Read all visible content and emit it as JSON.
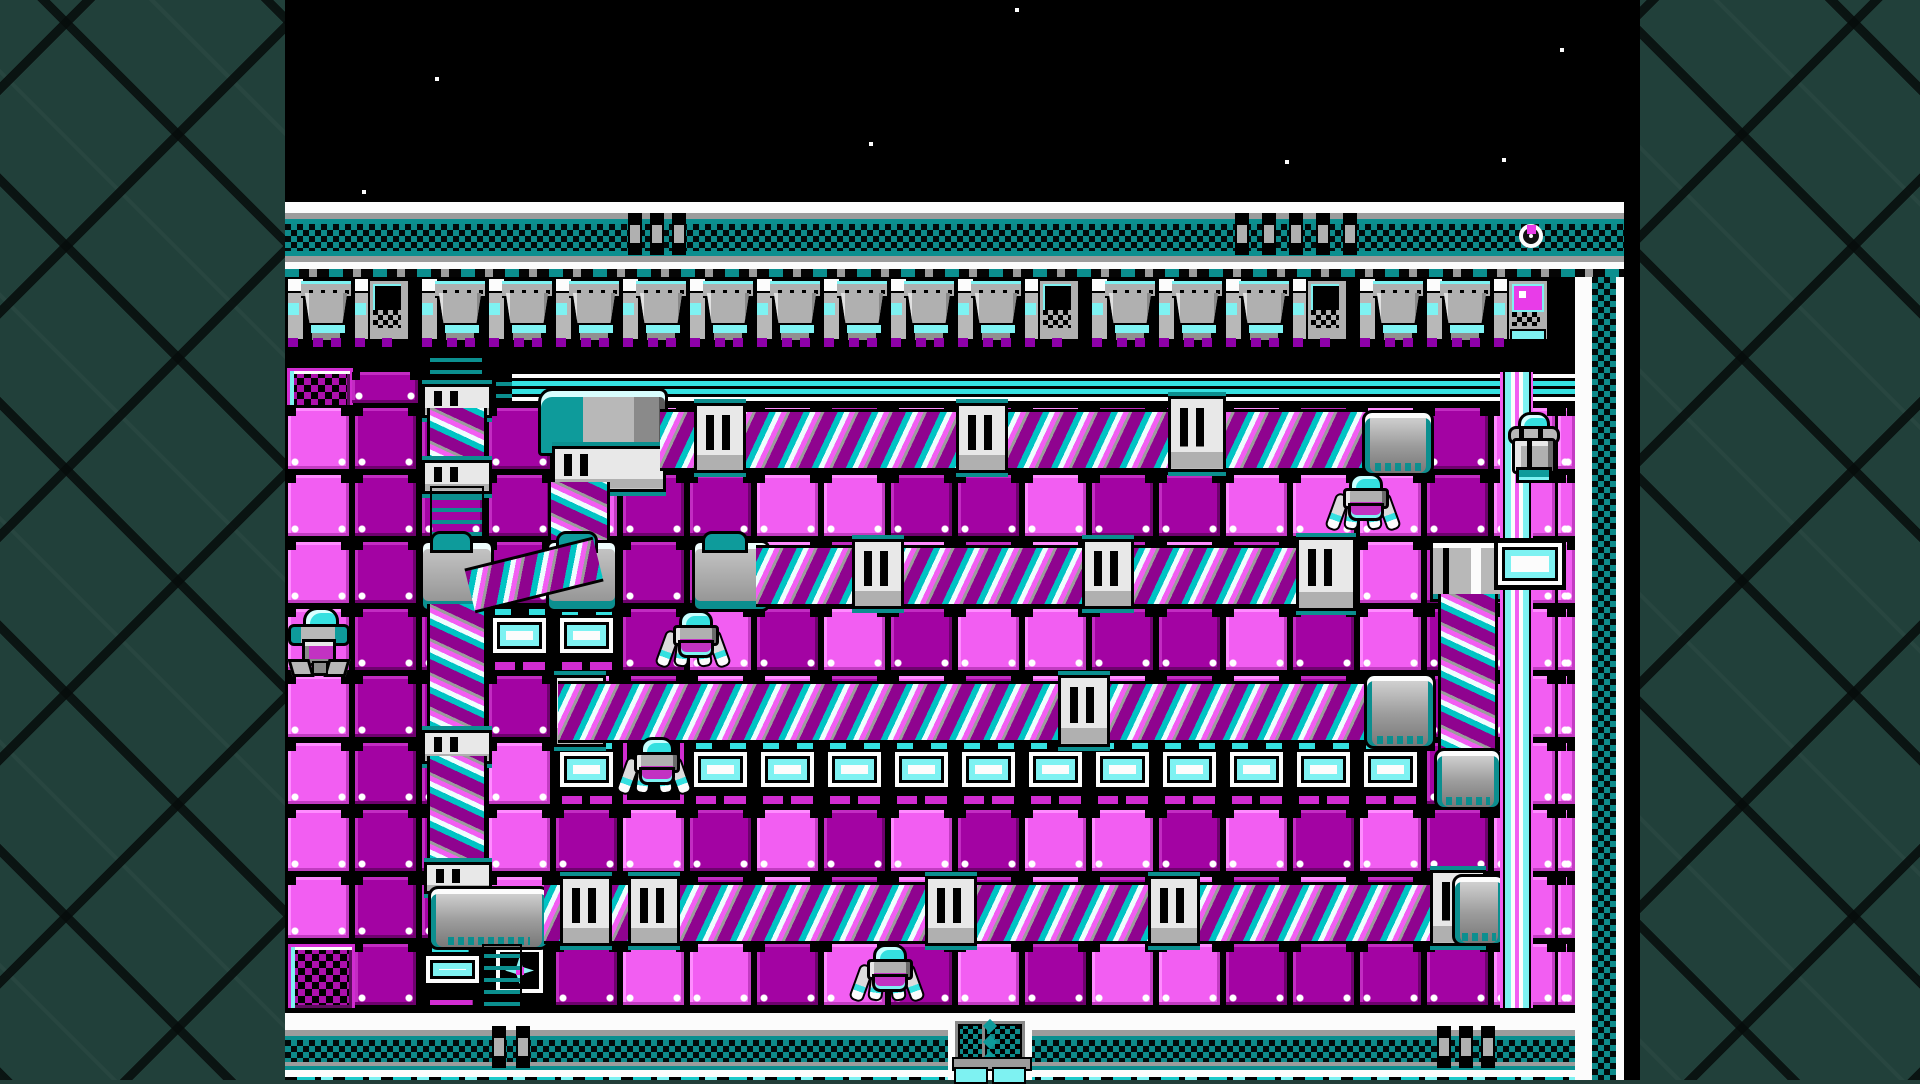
{
  "scene": "nes-action-stage-screenshot",
  "colors": {
    "background_lattice": "#21403a",
    "lattice_line": "#0a100f",
    "black": "#000000",
    "white": "#fcfcfc",
    "gray": "#9c9c9c",
    "light_gray": "#e8e8e8",
    "teal": "#0b8f8f",
    "teal_checker": "#0e8b8b",
    "cyan": "#35e0e0",
    "pale_cyan": "#7ef2f2",
    "magenta_bright": "#f25ef2",
    "magenta_mid": "#d12cd1",
    "purple_dark": "#a303a3",
    "shoe_purple": "#8e00a8"
  },
  "game_screen": {
    "x": 285,
    "y": 0,
    "width": 1355,
    "height": 1080
  },
  "starfield": {
    "height": 202,
    "stars": [
      [
        435,
        77
      ],
      [
        869,
        142
      ],
      [
        1015,
        8
      ],
      [
        1285,
        160
      ],
      [
        1502,
        158
      ],
      [
        1560,
        48
      ],
      [
        362,
        190
      ]
    ]
  },
  "top_band": {
    "y": 202,
    "layers": [
      {
        "name": "white",
        "y": 202,
        "h": 11
      },
      {
        "name": "gray",
        "y": 213,
        "h": 6
      },
      {
        "name": "teal",
        "y": 219,
        "h": 5
      },
      {
        "name": "checker",
        "y": 224,
        "h": 27
      },
      {
        "name": "teal",
        "y": 251,
        "h": 5
      },
      {
        "name": "gray",
        "y": 256,
        "h": 6
      },
      {
        "name": "white",
        "y": 262,
        "h": 7
      },
      {
        "name": "dashrow",
        "y": 269,
        "h": 8
      }
    ],
    "gates": [
      {
        "x": 628,
        "bars": 3,
        "gap": 22
      },
      {
        "x": 1235,
        "bars": 5,
        "gap": 27
      }
    ],
    "item": {
      "x": 1519,
      "y": 224
    }
  },
  "piston_row": {
    "y": 277,
    "h": 68,
    "count": 19,
    "variants": {
      "1": "hatch",
      "11": "hatch",
      "15": "hatch",
      "18": "screen"
    }
  },
  "strip": {
    "vent": {
      "x": 285,
      "y": 368,
      "w": 60,
      "h": 37
    },
    "dark": {
      "x": 352,
      "y": 372,
      "w": 66,
      "h": 31
    },
    "beam": {
      "x": 512,
      "y": 372,
      "w": 1063,
      "h": 31
    },
    "connector": {
      "x": 494,
      "y": 372,
      "w": 16,
      "h": 30
    }
  },
  "playfield": {
    "x": 285,
    "y": 405,
    "tile": 67,
    "cols": 19,
    "rows": 9,
    "legend": {
      "L": "light-tile",
      "D": "dark-tile",
      "C": "crate-tile",
      "K": "small-crate-tile",
      "S": "star-tile",
      "V": "vent-tile",
      "G": "spider-gap"
    },
    "map": [
      "LDDDDLDLDLDLDDLDLDL",
      "LDDDLDDLLDDLDDLLLDL",
      "LDDDDDDLDLDLDLDLLDL",
      "LDDCCDLDLDLLDDLDLDL",
      "LDDDLDLLDLDLLDLDLDL",
      "LDDLCGCCCCCCCCCCCDL",
      "LDDLDLDLDLDLLDLDLDL",
      "LDDLDLDLDLDLDLDLDDL",
      "VDKSDLLDLDLDLLDDDDL"
    ],
    "right_strip": {
      "x": 1558,
      "w": 17
    }
  },
  "machines": [
    {
      "type": "pipe",
      "x": 428,
      "y": 348,
      "w": 52,
      "h": 42
    },
    {
      "type": "plate",
      "x": 422,
      "y": 384,
      "w": 64,
      "h": 28
    },
    {
      "type": "threads-v",
      "x": 427,
      "y": 408,
      "w": 54,
      "h": 60
    },
    {
      "type": "plate",
      "x": 422,
      "y": 460,
      "w": 64,
      "h": 28
    },
    {
      "type": "pipe",
      "x": 430,
      "y": 486,
      "w": 50,
      "h": 54
    },
    {
      "type": "junction",
      "x": 420,
      "y": 540,
      "w": 68,
      "h": 66
    },
    {
      "type": "threads-v",
      "x": 427,
      "y": 604,
      "w": 54,
      "h": 130
    },
    {
      "type": "plate",
      "x": 422,
      "y": 730,
      "w": 64,
      "h": 28
    },
    {
      "type": "threads-v",
      "x": 427,
      "y": 756,
      "w": 54,
      "h": 112
    },
    {
      "type": "plate",
      "x": 424,
      "y": 862,
      "w": 62,
      "h": 26
    },
    {
      "type": "motor",
      "x": 428,
      "y": 886,
      "w": 116,
      "h": 58
    },
    {
      "type": "pipe",
      "x": 482,
      "y": 944,
      "w": 36,
      "h": 62
    },
    {
      "type": "dome-top",
      "x": 538,
      "y": 388,
      "w": 124,
      "h": 62
    },
    {
      "type": "plate",
      "x": 552,
      "y": 446,
      "w": 108,
      "h": 40
    },
    {
      "type": "threads-v",
      "x": 548,
      "y": 482,
      "w": 56,
      "h": 58
    },
    {
      "type": "junction",
      "x": 546,
      "y": 540,
      "w": 66,
      "h": 66
    },
    {
      "type": "threads-d",
      "x": 468,
      "y": 552,
      "w": 132,
      "h": 40,
      "angle": -14
    },
    {
      "type": "junction",
      "x": 692,
      "y": 540,
      "w": 72,
      "h": 66
    },
    {
      "type": "threads-h",
      "x": 660,
      "y": 409,
      "w": 706,
      "h": 56
    },
    {
      "type": "plate",
      "x": 694,
      "y": 403,
      "w": 46,
      "h": 64
    },
    {
      "type": "plate",
      "x": 956,
      "y": 403,
      "w": 46,
      "h": 64
    },
    {
      "type": "plate",
      "x": 1168,
      "y": 396,
      "w": 52,
      "h": 70
    },
    {
      "type": "motor",
      "x": 1362,
      "y": 410,
      "w": 66,
      "h": 60
    },
    {
      "type": "threads-h",
      "x": 756,
      "y": 545,
      "w": 545,
      "h": 56
    },
    {
      "type": "plate",
      "x": 852,
      "y": 539,
      "w": 46,
      "h": 64
    },
    {
      "type": "plate",
      "x": 1082,
      "y": 539,
      "w": 46,
      "h": 64
    },
    {
      "type": "plate",
      "x": 1296,
      "y": 537,
      "w": 54,
      "h": 68
    },
    {
      "type": "clamp",
      "x": 1430,
      "y": 540,
      "w": 68,
      "h": 56
    },
    {
      "type": "threads-v",
      "x": 1438,
      "y": 594,
      "w": 54,
      "h": 158
    },
    {
      "type": "motor",
      "x": 1434,
      "y": 748,
      "w": 62,
      "h": 56
    },
    {
      "type": "plate",
      "x": 554,
      "y": 675,
      "w": 46,
      "h": 66
    },
    {
      "type": "threads-h",
      "x": 558,
      "y": 681,
      "w": 810,
      "h": 56
    },
    {
      "type": "plate",
      "x": 1058,
      "y": 675,
      "w": 46,
      "h": 66
    },
    {
      "type": "motor",
      "x": 1364,
      "y": 673,
      "w": 66,
      "h": 70
    },
    {
      "type": "threads-h",
      "x": 544,
      "y": 882,
      "w": 892,
      "h": 56
    },
    {
      "type": "plate",
      "x": 560,
      "y": 876,
      "w": 46,
      "h": 64
    },
    {
      "type": "plate",
      "x": 628,
      "y": 876,
      "w": 46,
      "h": 64
    },
    {
      "type": "plate",
      "x": 925,
      "y": 876,
      "w": 46,
      "h": 64
    },
    {
      "type": "plate",
      "x": 1148,
      "y": 876,
      "w": 46,
      "h": 64
    },
    {
      "type": "plate",
      "x": 1430,
      "y": 870,
      "w": 50,
      "h": 70
    },
    {
      "type": "motor",
      "x": 1452,
      "y": 874,
      "w": 48,
      "h": 66
    }
  ],
  "pole": {
    "x": 1500,
    "y": 372,
    "w": 33,
    "h": 641,
    "crate": {
      "x": 1494,
      "y": 538,
      "w": 72,
      "h": 52
    }
  },
  "enemies": [
    {
      "type": "walker",
      "x": 288,
      "y": 607
    },
    {
      "type": "spider",
      "x": 660,
      "y": 610
    },
    {
      "type": "spider",
      "x": 621,
      "y": 737
    },
    {
      "type": "spider",
      "x": 854,
      "y": 944
    },
    {
      "type": "spider",
      "x": 1330,
      "y": 473
    },
    {
      "type": "rider",
      "x": 1502,
      "y": 412
    }
  ],
  "bottom_band": {
    "layers": [
      {
        "name": "black",
        "y": 1008,
        "h": 5
      },
      {
        "name": "white",
        "y": 1013,
        "h": 17
      },
      {
        "name": "gray",
        "y": 1030,
        "h": 6
      },
      {
        "name": "teal",
        "y": 1036,
        "h": 4
      },
      {
        "name": "checker",
        "y": 1040,
        "h": 22
      },
      {
        "name": "gray",
        "y": 1062,
        "h": 4
      },
      {
        "name": "teal",
        "y": 1066,
        "h": 4
      },
      {
        "name": "white",
        "y": 1070,
        "h": 7
      },
      {
        "name": "dashrow2",
        "y": 1077,
        "h": 3
      }
    ],
    "gates": [
      {
        "x": 492,
        "bars": 2,
        "gap": 24
      },
      {
        "x": 1437,
        "bars": 3,
        "gap": 22
      }
    ],
    "door": {
      "x": 948,
      "y": 1013,
      "w": 84,
      "h": 67
    }
  },
  "right_wall": {
    "white1": {
      "x": 1575,
      "w": 17
    },
    "checker": {
      "x": 1592,
      "w": 24
    },
    "white2": {
      "x": 1616,
      "w": 8
    },
    "black": {
      "x": 1624,
      "w": 16
    },
    "y": 277
  }
}
